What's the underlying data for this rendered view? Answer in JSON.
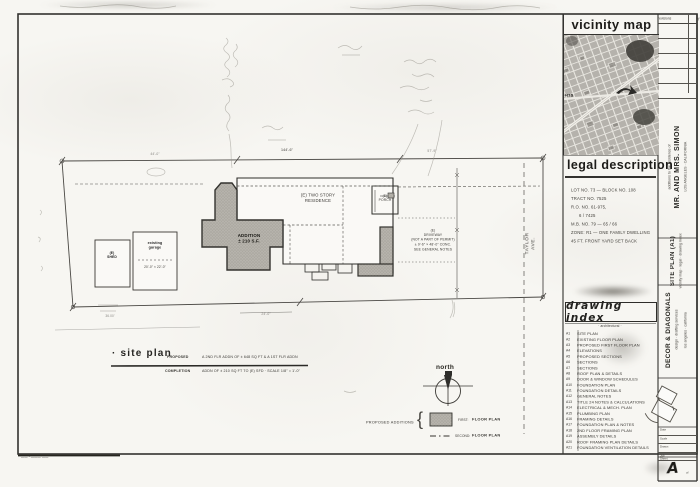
{
  "vicinity": {
    "title": "vicinity map",
    "hts": "HTS"
  },
  "legal": {
    "title": "legal description",
    "lines": [
      "LOT NO. 73 — BLOCK NO. 108",
      "TRACT NO. 7525",
      "R.O. NO. 61-975,",
      "6 / 7425",
      "M.B. NO. 79 — 65 / 66",
      "ZONE: R1 — ONE FAMILY DWELLING",
      "45 FT. FRONT YARD SET BACK"
    ]
  },
  "index": {
    "title": "drawing index",
    "subtitle": "· architectural ·",
    "rows": [
      {
        "no": "A1",
        "title": "SITE PLAN"
      },
      {
        "no": "A2",
        "title": "EXISTING FLOOR PLAN"
      },
      {
        "no": "A3",
        "title": "PROPOSED FIRST FLOOR PLAN"
      },
      {
        "no": "A4",
        "title": "ELEVATIONS"
      },
      {
        "no": "A5",
        "title": "PROPOSED SECTIONS"
      },
      {
        "no": "A6",
        "title": "SECTIONS"
      },
      {
        "no": "A7",
        "title": "SECTIONS"
      },
      {
        "no": "A8",
        "title": "ROOF PLAN & DETAILS"
      },
      {
        "no": "A9",
        "title": "DOOR & WINDOW SCHEDULES"
      },
      {
        "no": "A10",
        "title": "FOUNDATION PLAN"
      },
      {
        "no": "A11",
        "title": "FOUNDATION DETAILS"
      },
      {
        "no": "A12",
        "title": "GENERAL NOTES"
      },
      {
        "no": "A13",
        "title": "TITLE 24 NOTES & CALCULATIONS"
      },
      {
        "no": "A14",
        "title": "ELECTRICAL & MECH. PLAN"
      },
      {
        "no": "A15",
        "title": "PLUMBING PLAN"
      },
      {
        "no": "A16",
        "title": "FRAMING DETAILS"
      },
      {
        "no": "A17",
        "title": "FOUNDATION PLAN & NOTES"
      },
      {
        "no": "A18",
        "title": "2ND FLOOR FRAMING PLAN"
      },
      {
        "no": "A19",
        "title": "ASSEMBLY DETAILS"
      },
      {
        "no": "A20",
        "title": "ROOF FRAMING PLAN DETAILS"
      },
      {
        "no": "A21",
        "title": "FOUNDATION VENTILATION DETAILS"
      }
    ]
  },
  "revisions": {
    "title": "revisions",
    "by": "by"
  },
  "titleblock": {
    "project_small": "additions to the residence of",
    "project_name": "MR. AND MRS. SIMON",
    "project_addr": "LOS ANGELES · CALIFORNIA",
    "sheet_title": "SITE PLAN (A1)",
    "sheet_sub": "vicinity map · legal · drawing index",
    "firm": "DECOR & DIAGONALS",
    "firm_line1": "design · drafting services",
    "firm_line2": "los angeles · california",
    "fields": [
      {
        "label": "Date"
      },
      {
        "label": "Scale"
      },
      {
        "label": "Drawn"
      },
      {
        "label": "Job"
      }
    ],
    "sheet_label": "Sheet",
    "sheet_letter": "A",
    "sheet_of": "of"
  },
  "plan": {
    "title": "· site plan",
    "row1_key": "PROPOSED",
    "row1_note": "A 2ND FLR ADDN OF ± 648 SQ FT & A 1ST FLR ADDN",
    "row2_key": "COMPLETION",
    "row2_note": "ADDN OF ± 210 SQ FT TO (E) SFD · SCALE 1/8\" = 1'-0\"",
    "north": "north",
    "street": "TAYLOR AVE.",
    "legend_heading": "PROPOSED ADDITIONS",
    "legend_brace": "{",
    "legend_first_key": "FIRST:",
    "legend_first_val": "FLOOR PLAN",
    "legend_second_key": "SECOND:",
    "legend_second_val": "FLOOR PLAN",
    "labels": {
      "house": "(E) TWO STORY\nRESIDENCE",
      "porch": "(E)\nPORCH",
      "addition": "ADDITION\n± 210 S.F.",
      "shed": "(E)\nSHED",
      "garage": "existing\ngarage",
      "garage_sub": "20'-0\" × 22'-0\"",
      "driveway": "(E)\nDRIVEWAY\n(NOT A PART OF PERMIT)\n± 9'-6\" × 48'-0\" CONC.\nSEE GENERAL NOTES",
      "dim_top": "144'-6\"",
      "dim_left": "44'-0\"",
      "dim_right": "57'-9\"",
      "dim_bottom": "24'-0\"",
      "curb": "36.00'"
    }
  },
  "footer": {
    "fineprint": "—— · ——— ——"
  }
}
